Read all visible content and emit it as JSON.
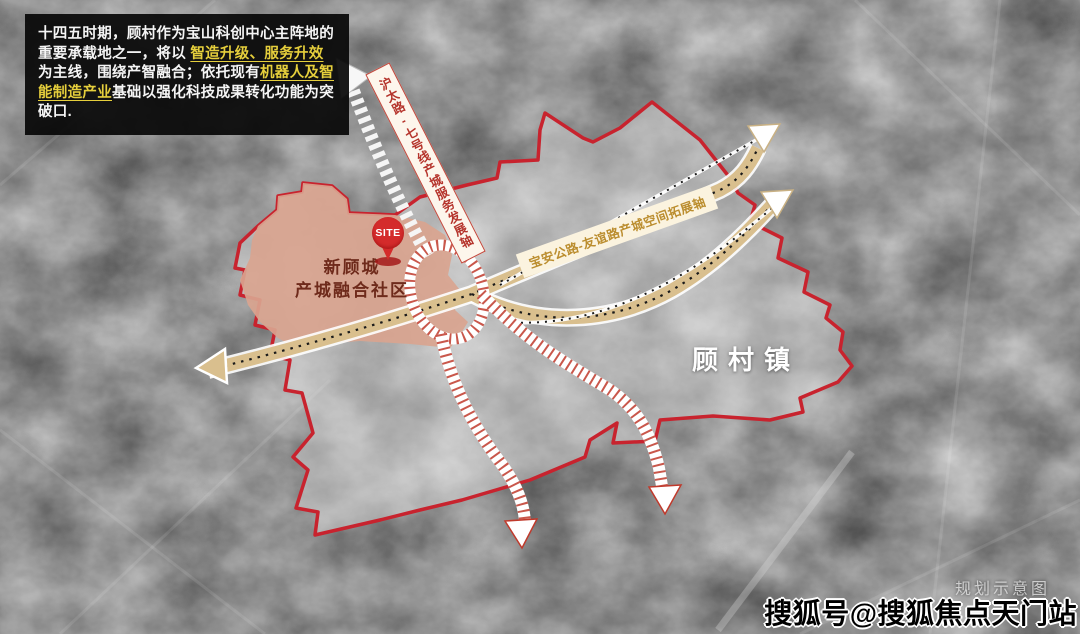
{
  "intro_box": {
    "segments": [
      {
        "text": "十四五时期，顾村作为宝山科创中心主阵地的重要承载地之一，将以 ",
        "highlight": false
      },
      {
        "text": "智造升级、服务升效",
        "highlight": true
      },
      {
        "text": " 为主线，围绕产智融合；依托现有",
        "highlight": false
      },
      {
        "text": "机器人及智能制造产业",
        "highlight": true
      },
      {
        "text": "基础以强化科技成果转化功能为突破口.",
        "highlight": false
      }
    ]
  },
  "map": {
    "site_marker": {
      "label": "SITE"
    },
    "community": {
      "line1": "新顾城",
      "line2": "产城融合社区"
    },
    "town": {
      "label": "顾村镇"
    },
    "axis_rail": {
      "label": "沪太路-七号线产城服务发展轴"
    },
    "axis_road": {
      "label": "宝安公路-友谊路产城空间拓展轴"
    },
    "note": "规划示意图"
  },
  "watermark": {
    "text": "搜狐号@搜狐焦点天门站"
  },
  "colors": {
    "boundary_red": "#c8232e",
    "community_fill": "#d9a48f",
    "rail_accent": "#c0392b",
    "road_band": "#d9bf8e",
    "highlight_yellow": "#e6cf3c",
    "intro_bg": "#080808"
  }
}
